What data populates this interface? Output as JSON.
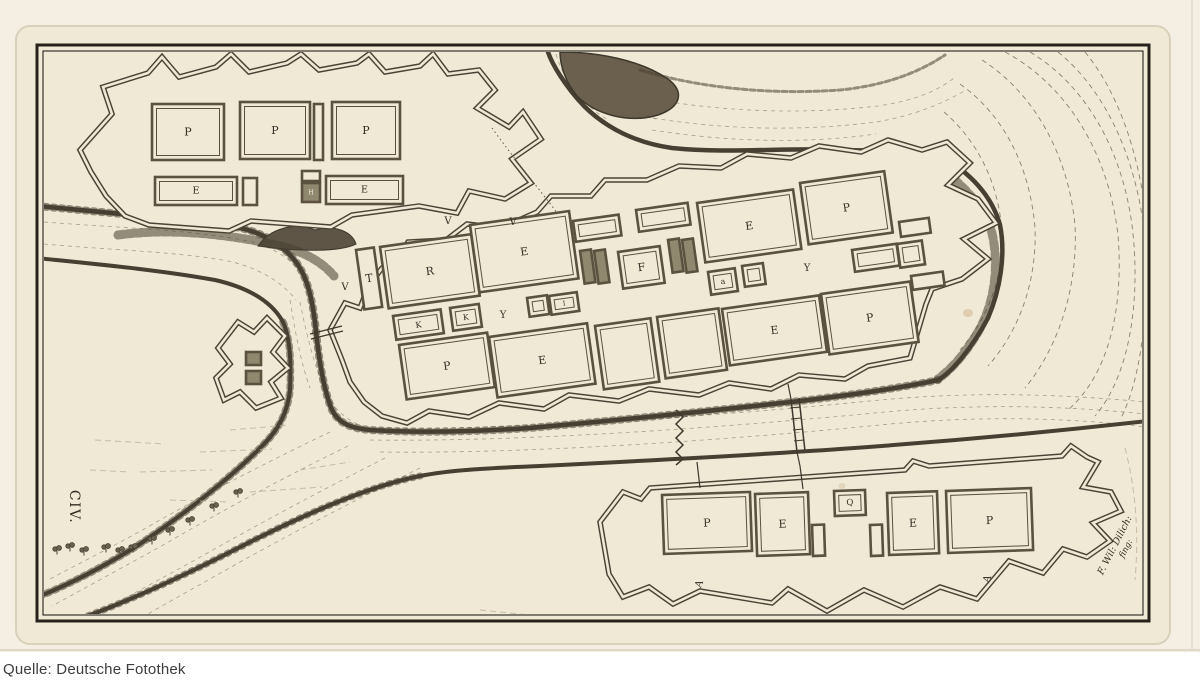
{
  "caption": {
    "text": "Quelle: Deutsche Fotothek"
  },
  "plate": {
    "label_civ": "CIV.",
    "signature_line1": "F. Wil: Dilich:",
    "signature_line2": "fing:"
  },
  "palette": {
    "paper": "#f0e9d6",
    "paper_margin": "#f4efe2",
    "ink": "#3a342a",
    "wall": "#4a4234",
    "bank": "#473f31",
    "water_line": "#7a6f5a",
    "caption_text": "#3d3d3d"
  },
  "map_data": {
    "north_fort_blocks": [
      {
        "label": "P",
        "x": 152,
        "y": 104,
        "w": 72,
        "h": 56
      },
      {
        "label": "P",
        "x": 240,
        "y": 102,
        "w": 70,
        "h": 57
      },
      {
        "label": "",
        "x": 314,
        "y": 104,
        "w": 9,
        "h": 56
      },
      {
        "label": "P",
        "x": 332,
        "y": 102,
        "w": 68,
        "h": 57
      },
      {
        "label": "E",
        "x": 155,
        "y": 177,
        "w": 82,
        "h": 28
      },
      {
        "label": "",
        "x": 243,
        "y": 178,
        "w": 14,
        "h": 27
      },
      {
        "label": "",
        "x": 302,
        "y": 171,
        "w": 18,
        "h": 10
      },
      {
        "label": "H",
        "x": 302,
        "y": 183,
        "w": 18,
        "h": 19,
        "shaded": true
      },
      {
        "label": "E",
        "x": 326,
        "y": 176,
        "w": 77,
        "h": 28
      }
    ],
    "city_blocks": [
      {
        "label": "T",
        "x": 356,
        "y": 250,
        "w": 18,
        "h": 60
      },
      {
        "label": "R",
        "x": 380,
        "y": 247,
        "w": 92,
        "h": 62
      },
      {
        "label": "E",
        "x": 470,
        "y": 225,
        "w": 100,
        "h": 68
      },
      {
        "label": "",
        "x": 573,
        "y": 221,
        "w": 46,
        "h": 21
      },
      {
        "label": "",
        "x": 580,
        "y": 251,
        "w": 11,
        "h": 33,
        "shaded": true
      },
      {
        "label": "",
        "x": 594,
        "y": 251,
        "w": 11,
        "h": 33,
        "shaded": true
      },
      {
        "label": "",
        "x": 636,
        "y": 210,
        "w": 52,
        "h": 22
      },
      {
        "label": "F",
        "x": 618,
        "y": 252,
        "w": 42,
        "h": 37
      },
      {
        "label": "",
        "x": 668,
        "y": 240,
        "w": 11,
        "h": 33,
        "shaded": true
      },
      {
        "label": "",
        "x": 682,
        "y": 240,
        "w": 11,
        "h": 33,
        "shaded": true
      },
      {
        "label": "E",
        "x": 697,
        "y": 203,
        "w": 97,
        "h": 60
      },
      {
        "label": "P",
        "x": 800,
        "y": 183,
        "w": 85,
        "h": 62
      },
      {
        "label": "",
        "x": 852,
        "y": 250,
        "w": 45,
        "h": 22
      },
      {
        "label": "",
        "x": 897,
        "y": 244,
        "w": 25,
        "h": 24
      },
      {
        "label": "",
        "x": 899,
        "y": 222,
        "w": 30,
        "h": 15
      },
      {
        "label": "",
        "x": 911,
        "y": 276,
        "w": 32,
        "h": 14
      },
      {
        "label": "K",
        "x": 393,
        "y": 316,
        "w": 48,
        "h": 24
      },
      {
        "label": "K",
        "x": 450,
        "y": 308,
        "w": 29,
        "h": 23
      },
      {
        "label": "",
        "x": 527,
        "y": 298,
        "w": 20,
        "h": 19
      },
      {
        "label": "I",
        "x": 549,
        "y": 296,
        "w": 28,
        "h": 19
      },
      {
        "label": "a",
        "x": 708,
        "y": 272,
        "w": 27,
        "h": 23
      },
      {
        "label": "",
        "x": 742,
        "y": 266,
        "w": 21,
        "h": 21
      },
      {
        "label": "P",
        "x": 399,
        "y": 345,
        "w": 89,
        "h": 55
      },
      {
        "label": "E",
        "x": 489,
        "y": 337,
        "w": 99,
        "h": 61
      },
      {
        "label": "",
        "x": 595,
        "y": 326,
        "w": 56,
        "h": 64
      },
      {
        "label": "",
        "x": 657,
        "y": 317,
        "w": 62,
        "h": 62
      },
      {
        "label": "E",
        "x": 722,
        "y": 309,
        "w": 98,
        "h": 57
      },
      {
        "label": "P",
        "x": 821,
        "y": 294,
        "w": 90,
        "h": 61
      }
    ],
    "outwork_blocks": [
      {
        "label": "",
        "x": 246,
        "y": 352,
        "w": 15,
        "h": 13,
        "shaded": true
      },
      {
        "label": "",
        "x": 246,
        "y": 371,
        "w": 15,
        "h": 13,
        "shaded": true
      }
    ],
    "south_fort_blocks": [
      {
        "label": "P",
        "x": 662,
        "y": 495,
        "w": 88,
        "h": 59
      },
      {
        "label": "E",
        "x": 755,
        "y": 494,
        "w": 53,
        "h": 62
      },
      {
        "label": "",
        "x": 812,
        "y": 525,
        "w": 12,
        "h": 31
      },
      {
        "label": "Q",
        "x": 834,
        "y": 491,
        "w": 31,
        "h": 25
      },
      {
        "label": "",
        "x": 870,
        "y": 525,
        "w": 12,
        "h": 31
      },
      {
        "label": "E",
        "x": 887,
        "y": 493,
        "w": 50,
        "h": 62
      },
      {
        "label": "P",
        "x": 946,
        "y": 491,
        "w": 85,
        "h": 62
      }
    ],
    "street_labels": [
      {
        "text": "V",
        "x": 345,
        "y": 290
      },
      {
        "text": "V",
        "x": 448,
        "y": 224
      },
      {
        "text": "V",
        "x": 513,
        "y": 225
      },
      {
        "text": "Y",
        "x": 503,
        "y": 318
      },
      {
        "text": "Y",
        "x": 807,
        "y": 271
      },
      {
        "text": "A",
        "x": 702,
        "y": 585,
        "r": -70
      },
      {
        "text": "A",
        "x": 990,
        "y": 580,
        "r": -70
      }
    ]
  }
}
